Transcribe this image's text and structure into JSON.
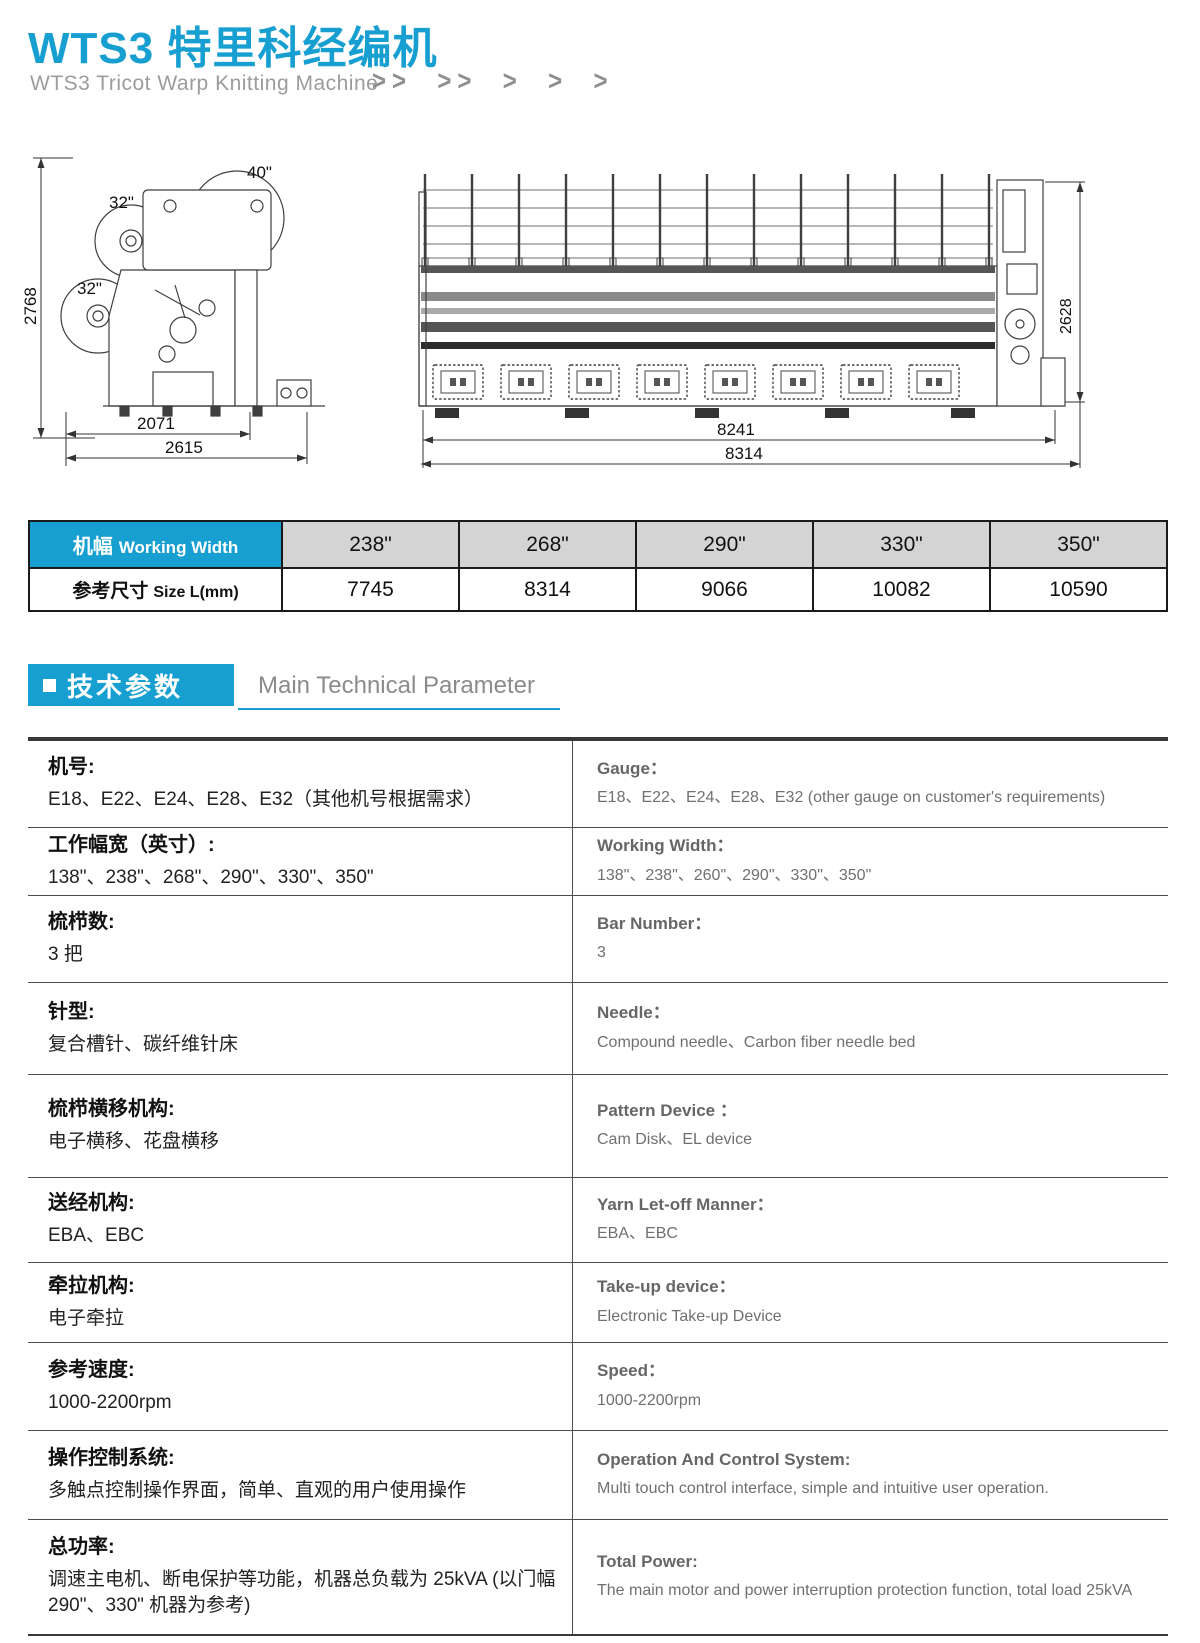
{
  "header": {
    "title": "WTS3 特里科经编机",
    "subtitle": "WTS3 Tricot Warp Knitting Machine",
    "chevrons": ">>  >>  >  >  >"
  },
  "side_view": {
    "dim_height": "2768",
    "beam_top": "40\"",
    "beam_mid": "32\"",
    "beam_low": "32\"",
    "dim_width_inner": "2071",
    "dim_width_outer": "2615"
  },
  "front_view": {
    "dim_height": "2628",
    "dim_width_inner": "8241",
    "dim_width_outer": "8314"
  },
  "width_table": {
    "header_cn": "机幅",
    "header_en": "Working Width",
    "row_cn": "参考尺寸",
    "row_en": "Size L(mm)",
    "widths": [
      "238\"",
      "268\"",
      "290\"",
      "330\"",
      "350\""
    ],
    "sizes": [
      "7745",
      "8314",
      "9066",
      "10082",
      "10590"
    ]
  },
  "section": {
    "cn": "技术参数",
    "en": "Main Technical Parameter"
  },
  "spec": {
    "rows": [
      {
        "cn_title": "机号:",
        "cn_value": "E18、E22、E24、E28、E32（其他机号根据需求）",
        "en_title": "Gauge：",
        "en_value": "E18、E22、E24、E28、E32 (other gauge on customer's requirements)"
      },
      {
        "cn_title": "工作幅宽（英寸）:",
        "cn_value": "138\"、238\"、268\"、290\"、330\"、350\"",
        "en_title": "Working Width：",
        "en_value": "138\"、238\"、260\"、290\"、330\"、350\""
      },
      {
        "cn_title": "梳栉数:",
        "cn_value": "3 把",
        "en_title": "Bar Number：",
        "en_value": "3"
      },
      {
        "cn_title": "针型:",
        "cn_value": "复合槽针、碳纤维针床",
        "en_title": "Needle：",
        "en_value": "Compound needle、Carbon fiber needle bed"
      },
      {
        "cn_title": "梳栉横移机构:",
        "cn_value": "电子横移、花盘横移",
        "en_title": "Pattern Device ：",
        "en_value": "Cam Disk、EL device"
      },
      {
        "cn_title": "送经机构:",
        "cn_value": "EBA、EBC",
        "en_title": "Yarn Let-off Manner：",
        "en_value": "EBA、EBC"
      },
      {
        "cn_title": "牵拉机构:",
        "cn_value": "电子牵拉",
        "en_title": "Take-up device：",
        "en_value": "Electronic Take-up Device"
      },
      {
        "cn_title": "参考速度:",
        "cn_value": "1000-2200rpm",
        "en_title": "Speed：",
        "en_value": "1000-2200rpm"
      },
      {
        "cn_title": "操作控制系统:",
        "cn_value": "多触点控制操作界面，简单、直观的用户使用操作",
        "en_title": "Operation And Control System:",
        "en_value": "Multi touch control interface, simple and intuitive user operation."
      },
      {
        "cn_title": "总功率:",
        "cn_value": "调速主电机、断电保护等功能，机器总负载为 25kVA (以门幅 290\"、330\" 机器为参考)",
        "en_title": "Total Power:",
        "en_value": "The main motor and power interruption protection function,  total load 25kVA"
      }
    ]
  }
}
